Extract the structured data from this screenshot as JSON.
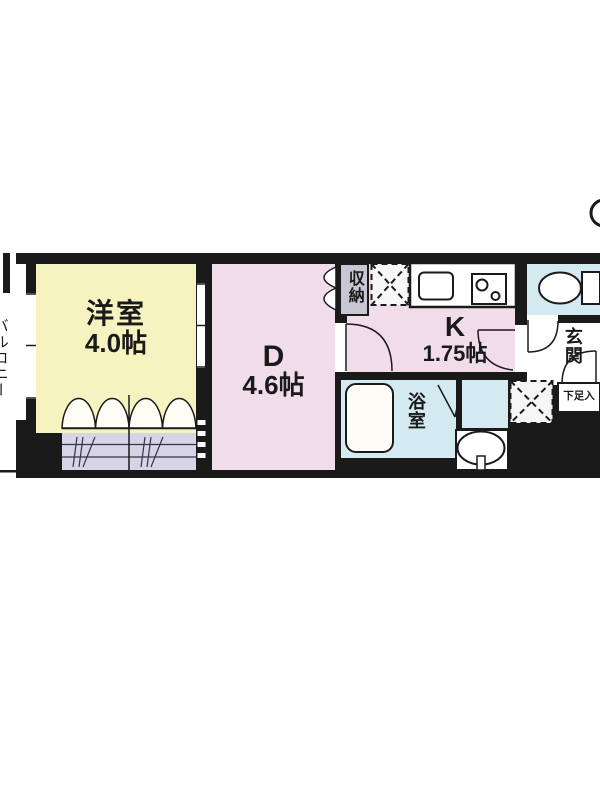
{
  "floorplan": {
    "title": "1DK floor plan",
    "rooms": {
      "balcony": {
        "label": "バルコニー"
      },
      "western_room": {
        "label": "洋室",
        "size": "4.0帖"
      },
      "dining": {
        "label": "D",
        "size": "4.6帖"
      },
      "kitchen": {
        "label": "K",
        "size": "1.75帖"
      },
      "storage": {
        "label": "収納"
      },
      "entrance": {
        "label": "玄関"
      },
      "shoe_box": {
        "label": "下足入"
      },
      "bathroom": {
        "label": "浴室"
      }
    },
    "colors": {
      "wall": "#1a1a1a",
      "western_room_fill": "#f6f3c1",
      "dining_kitchen_fill": "#f1dde9",
      "closet_fill": "#d8d4e6",
      "storage_fill": "#c7c7d4",
      "wet_area_fill": "#d3eaf0"
    }
  }
}
